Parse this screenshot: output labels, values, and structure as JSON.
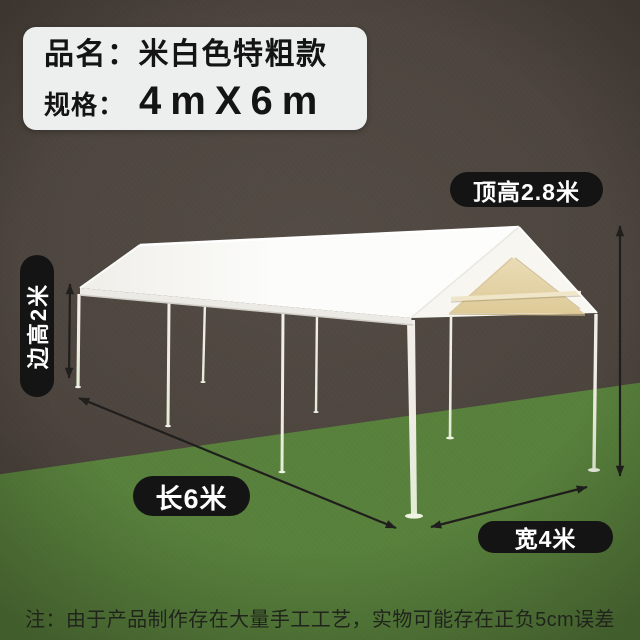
{
  "product": {
    "name_label": "品名：",
    "name_value": "米白色特粗款",
    "spec_label": "规格：",
    "spec_value": "4mX6m"
  },
  "dimensions": {
    "top_height": "顶高2.8米",
    "side_height": "边高2米",
    "length": "长6米",
    "width": "宽4米"
  },
  "note": "注：由于产品制作存在大量手工工艺，实物可能存在正负5cm误差",
  "colors": {
    "background": "#4a423b",
    "ground": "#58813c",
    "pill_bg": "#141414",
    "pill_text": "#ffffff",
    "canopy_white": "#fbfbf9",
    "canopy_interior_beige": "#e6d5ab",
    "spec_box_bg": "#edefee",
    "text_ink": "#141414",
    "arrow": "#201f1d"
  }
}
